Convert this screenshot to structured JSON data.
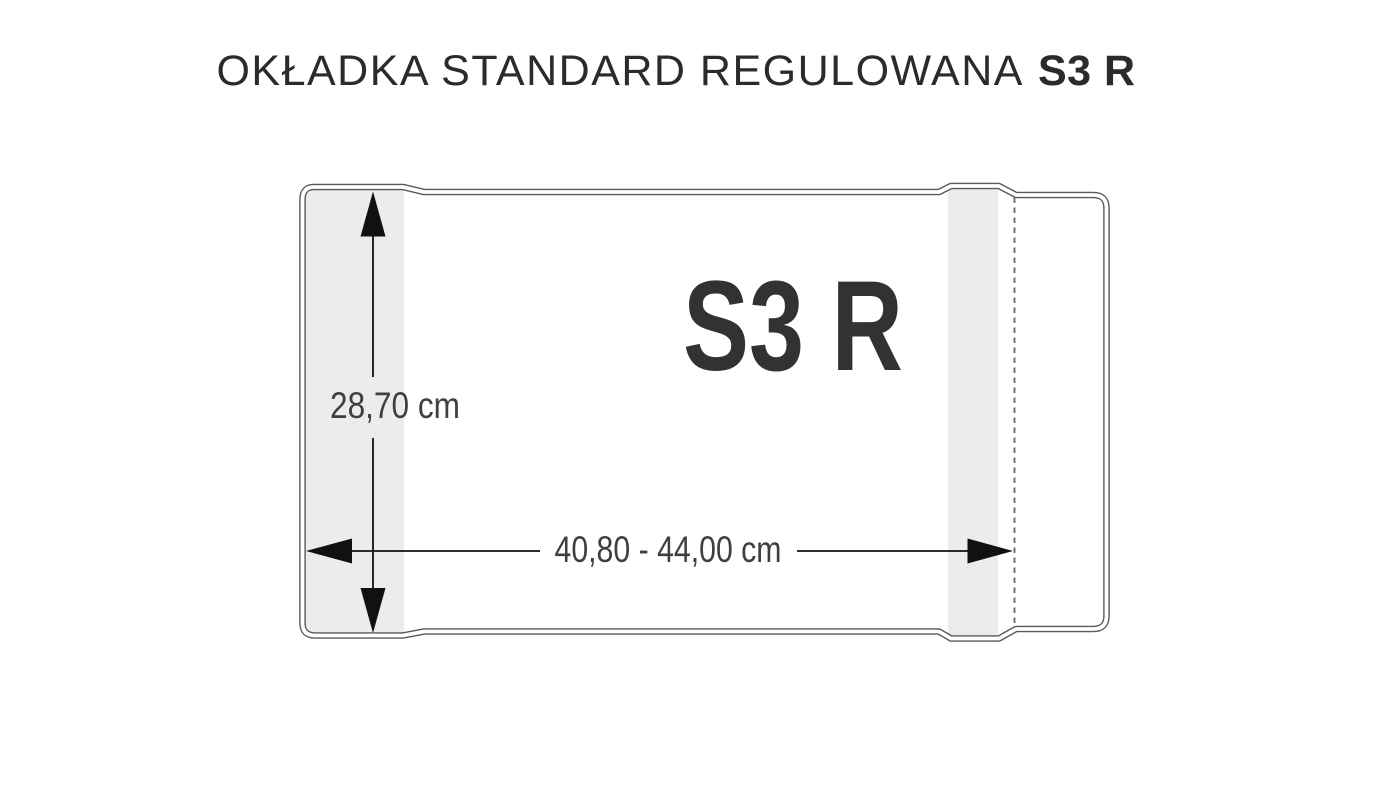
{
  "title": {
    "regular": "OKŁADKA STANDARD REGULOWANA",
    "bold": "S3 R"
  },
  "diagram": {
    "product_code": "S3 R",
    "height_label": "28,70 cm",
    "width_label": "40,80 - 44,00 cm",
    "colors": {
      "outline": "#58595b",
      "band": "#ebecec",
      "dashed": "#6d6e71",
      "arrow": "#111111",
      "label": "#3f3f3f",
      "code": "#323232"
    }
  }
}
